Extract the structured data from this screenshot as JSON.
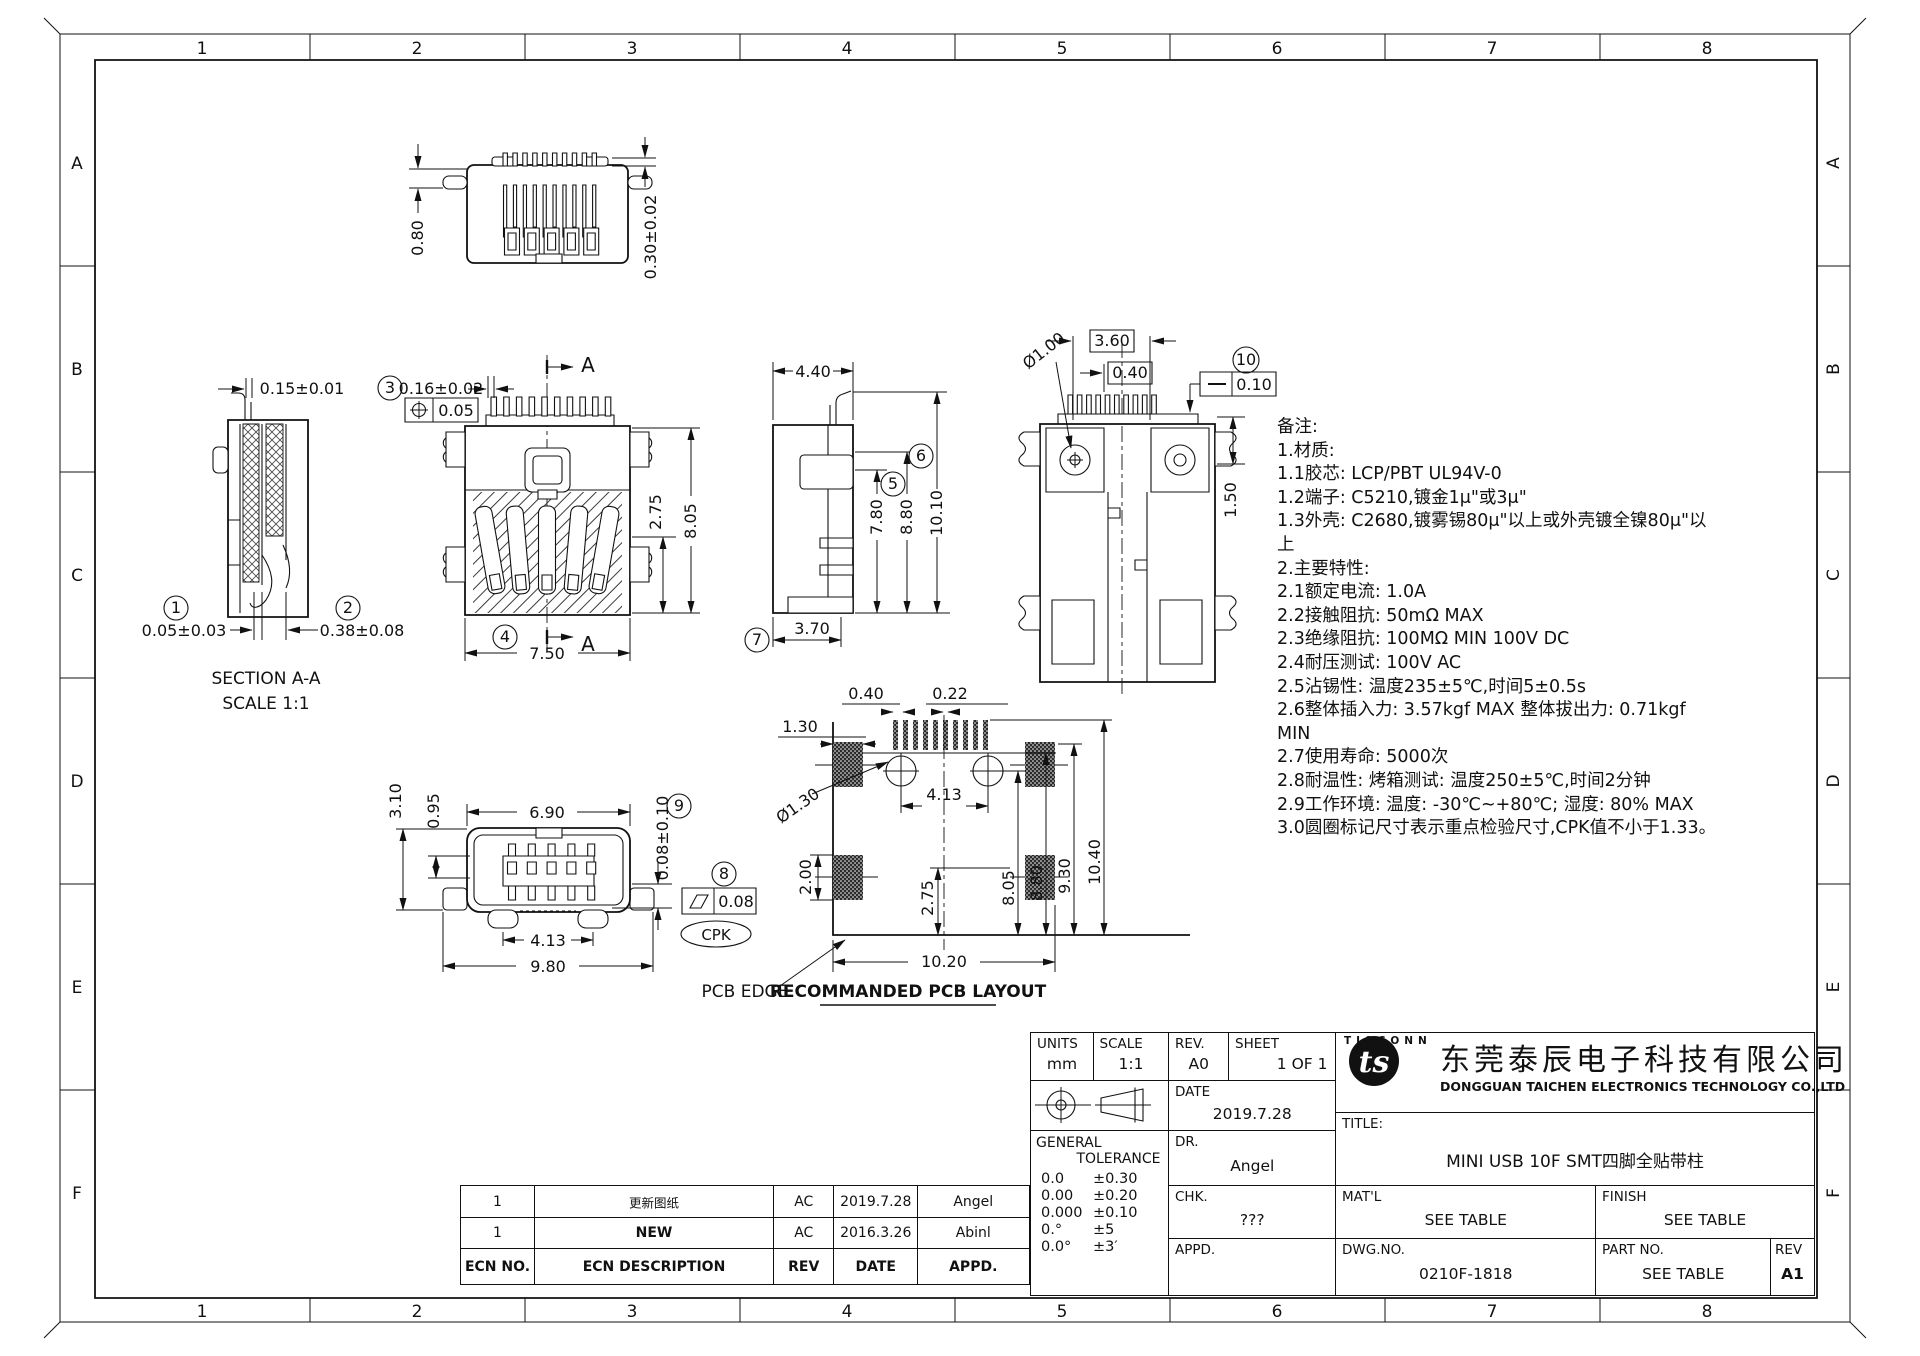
{
  "sheet": {
    "cols": [
      "1",
      "2",
      "3",
      "4",
      "5",
      "6",
      "7",
      "8"
    ],
    "rows": [
      "A",
      "B",
      "C",
      "D",
      "E",
      "F"
    ]
  },
  "views": {
    "rear_top": {
      "d1": "0.80",
      "d2": "0.30±0.02"
    },
    "section": {
      "b1": "1",
      "b2": "2",
      "d_slot": "0.15±0.01",
      "d1": "0.05±0.03",
      "d2": "0.38±0.08",
      "title": "SECTION A-A",
      "scale": "SCALE 1:1"
    },
    "front": {
      "b3": "3",
      "b4": "4",
      "d_pin": "0.16±0.02",
      "pos_tol": "0.05",
      "d_w": "7.50",
      "d_h1": "2.75",
      "d_h2": "8.05",
      "sec": "A"
    },
    "side": {
      "d_w": "4.40",
      "b5": "5",
      "b6": "6",
      "b7": "7",
      "d1": "7.80",
      "d2": "8.80",
      "d3": "10.10",
      "d4": "3.70"
    },
    "rear": {
      "d1": "3.60",
      "d2": "0.40",
      "b10": "10",
      "st_tol": "0.10",
      "d3": "Ø1.00",
      "d4": "1.50"
    },
    "bottom": {
      "d1": "3.10",
      "d2": "0.95",
      "d3": "6.90",
      "b9": "9",
      "d4": "0.08±0.10",
      "b8": "8",
      "flat_tol": "0.08",
      "cpk": "CPK",
      "d5": "4.13",
      "d6": "9.80"
    },
    "pcb": {
      "d1": "0.40",
      "d2": "0.22",
      "d3": "1.30",
      "d4": "Ø1.30",
      "d5": "4.13",
      "d6": "2.00",
      "d7": "2.75",
      "d8": "8.05",
      "d9": "8.80",
      "d10": "9.30",
      "d11": "10.40",
      "d12": "10.20",
      "edge": "PCB EDGE",
      "caption": "RECOMMANDED PCB LAYOUT"
    }
  },
  "notes": {
    "lines": [
      "备注:",
      "1.材质:",
      "1.1胶芯: LCP/PBT UL94V-0",
      "1.2端子: C5210,镀金1μ\"或3μ\"",
      "1.3外壳: C2680,镀雾锡80μ\"以上或外壳镀全镍80μ\"以",
      "上",
      "2.主要特性:",
      "2.1额定电流: 1.0A",
      "2.2接触阻抗: 50mΩ MAX",
      "2.3绝缘阻抗: 100MΩ MIN 100V DC",
      "2.4耐压测试: 100V AC",
      "2.5沾锡性: 温度235±5℃,时间5±0.5s",
      "2.6整体插入力: 3.57kgf MAX  整体拔出力: 0.71kgf",
      "MIN",
      "2.7使用寿命: 5000次",
      "2.8耐温性: 烤箱测试: 温度250±5℃,时间2分钟",
      "2.9工作环境: 温度: -30℃~+80℃; 湿度: 80% MAX",
      "3.0圆圈标记尺寸表示重点检验尺寸,CPK值不小于1.33。"
    ]
  },
  "titleblock": {
    "units_label": "UNITS",
    "units": "mm",
    "scale_label": "SCALE",
    "scale": "1:1",
    "rev_label": "REV.",
    "rev": "A0",
    "sheet_label": "SHEET",
    "sheet": "1 OF 1",
    "date_label": "DATE",
    "date": "2019.7.28",
    "dr_label": "DR.",
    "dr": "Angel",
    "chk_label": "CHK.",
    "chk": "???",
    "appd_label": "APPD.",
    "appd": "",
    "general": "GENERAL",
    "tolerance": "TOLERANCE",
    "tol_rows": [
      [
        "0.0",
        "±0.30"
      ],
      [
        "0.00",
        "±0.20"
      ],
      [
        "0.000",
        "±0.10"
      ],
      [
        "0.°",
        "±5"
      ],
      [
        "0.0°",
        "±3′"
      ]
    ],
    "title_label": "TITLE:",
    "title": "MINI USB 10F SMT四脚全贴带柱",
    "matl_label": "MAT'L",
    "matl": "SEE TABLE",
    "finish_label": "FINISH",
    "finish": "SEE TABLE",
    "dwg_label": "DWG.NO.",
    "dwg": "0210F-1818",
    "part_label": "PART NO.",
    "part": "SEE TABLE",
    "rev2_label": "REV",
    "rev2": "A1",
    "brand": "TISCONN",
    "logo_text": "ts",
    "company_cn": "东莞泰辰电子科技有限公司",
    "company_en": "DONGGUAN TAICHEN ELECTRONICS TECHNOLOGY CO.,LTD"
  },
  "ecn": {
    "headers": [
      "ECN NO.",
      "ECN  DESCRIPTION",
      "REV",
      "DATE",
      "APPD."
    ],
    "rows": [
      [
        "1",
        "更新图纸",
        "AC",
        "2019.7.28",
        "Angel"
      ],
      [
        "1",
        "NEW",
        "AC",
        "2016.3.26",
        "Abinl"
      ]
    ]
  }
}
